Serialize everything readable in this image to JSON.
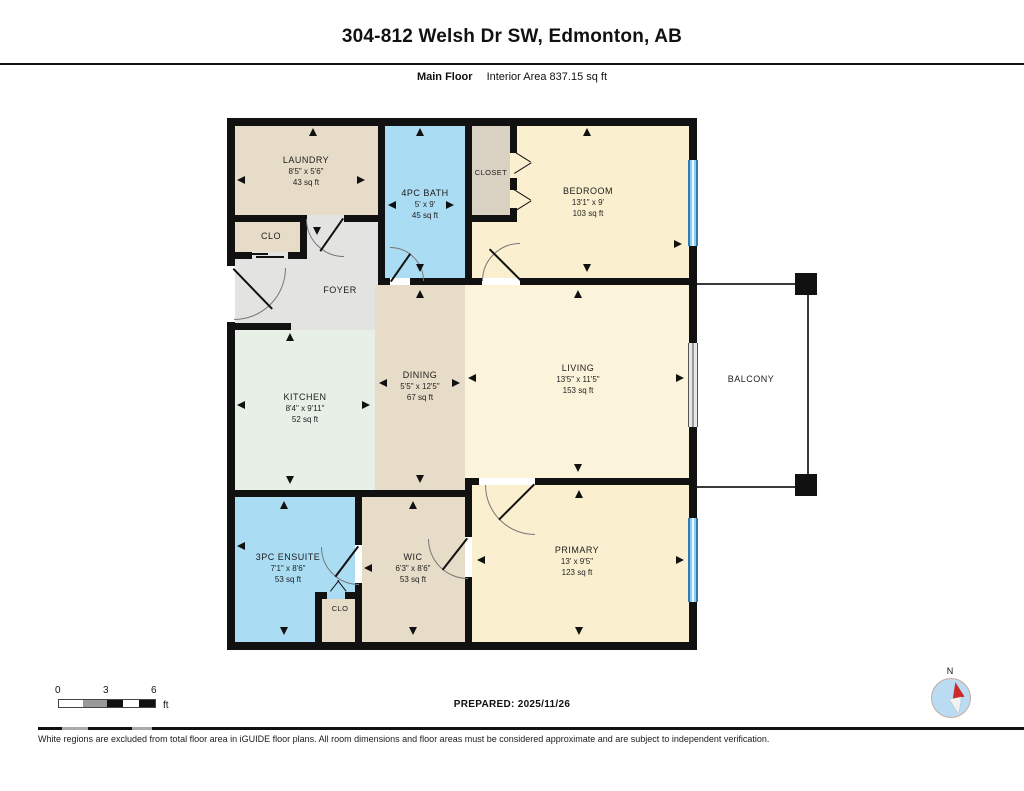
{
  "header": {
    "title": "304-812 Welsh Dr SW, Edmonton, AB",
    "floor_label": "Main Floor",
    "area_label": "Interior Area 837.15 sq ft"
  },
  "rooms": {
    "laundry": {
      "name": "LAUNDRY",
      "dims": "8'5\" x 5'6\"",
      "area": "43 sq ft"
    },
    "bath4pc": {
      "name": "4PC BATH",
      "dims": "5' x 9'",
      "area": "45 sq ft"
    },
    "closet": {
      "name": "CLOSET"
    },
    "bedroom": {
      "name": "BEDROOM",
      "dims": "13'1\" x 9'",
      "area": "103 sq ft"
    },
    "clo_top": {
      "name": "CLO"
    },
    "foyer": {
      "name": "FOYER"
    },
    "kitchen": {
      "name": "KITCHEN",
      "dims": "8'4\" x 9'11\"",
      "area": "52 sq ft"
    },
    "dining": {
      "name": "DINING",
      "dims": "5'5\" x 12'5\"",
      "area": "67 sq ft"
    },
    "living": {
      "name": "LIVING",
      "dims": "13'5\" x 11'5\"",
      "area": "153 sq ft"
    },
    "balcony": {
      "name": "BALCONY"
    },
    "ensuite": {
      "name": "3PC ENSUITE",
      "dims": "7'1\" x 8'6\"",
      "area": "53 sq ft"
    },
    "wic": {
      "name": "WIC",
      "dims": "6'3\" x 8'6\"",
      "area": "53 sq ft"
    },
    "clo_bottom": {
      "name": "CLO"
    },
    "primary": {
      "name": "PRIMARY",
      "dims": "13' x 9'5\"",
      "area": "123 sq ft"
    }
  },
  "footer": {
    "prepared": "PREPARED: 2025/11/26",
    "disclaimer": "White regions are excluded from total floor area in iGUIDE floor plans. All room dimensions and floor areas must be considered approximate and are subject to independent verification.",
    "scale": {
      "tick0": "0",
      "tick3": "3",
      "tick6": "6",
      "unit": "ft"
    },
    "compass_label": "N"
  },
  "colors": {
    "wall": "#111111",
    "tan": "#e7dcc7",
    "closet_tan": "#d9d2c3",
    "bath_blue": "#aadcf3",
    "cream": "#faf0cf",
    "living_cream": "#fbf4da",
    "kitchen_green": "#e7efe7",
    "foyer_gray": "#e3e3e1",
    "window_blue": "#8fcdf0",
    "compass_red": "#cc2a2a"
  }
}
